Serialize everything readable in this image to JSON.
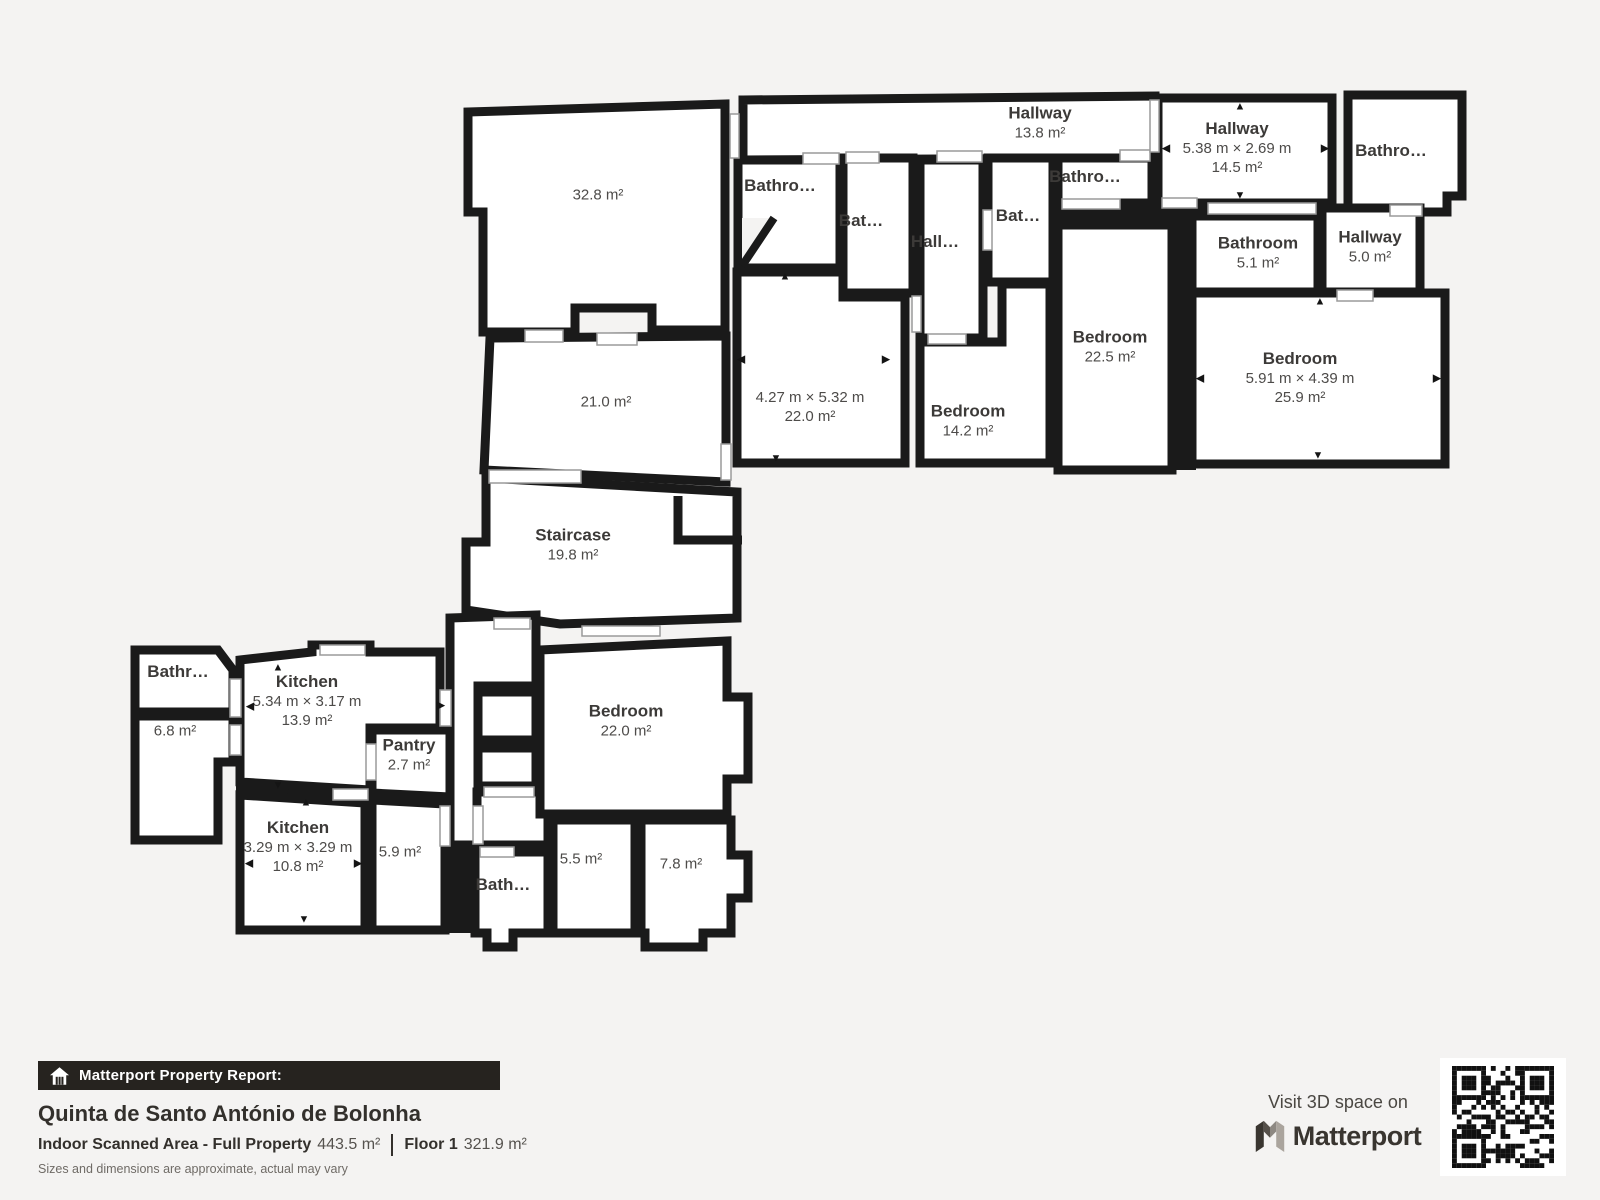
{
  "page": {
    "background": "#f4f3f2",
    "wall_color": "#1a1a1a"
  },
  "plan": {
    "rooms": [
      {
        "area": "32.8 m²",
        "x": 598,
        "y": 195
      },
      {
        "area": "21.0 m²",
        "x": 606,
        "y": 402
      },
      {
        "name": "Staircase",
        "area": "19.8 m²",
        "x": 573,
        "y": 545
      },
      {
        "name": "Hallway",
        "area": "13.8 m²",
        "x": 1040,
        "y": 123
      },
      {
        "name": "Hallway",
        "dims": "5.38 m × 2.69 m",
        "area": "14.5 m²",
        "x": 1237,
        "y": 148
      },
      {
        "name": "Bathro…",
        "x": 1391,
        "y": 151
      },
      {
        "name": "Bathroom",
        "area": "5.1 m²",
        "x": 1258,
        "y": 253
      },
      {
        "name": "Hallway",
        "area": "5.0 m²",
        "x": 1370,
        "y": 247
      },
      {
        "name": "Bathro…",
        "x": 780,
        "y": 186
      },
      {
        "name": "Bat…",
        "x": 861,
        "y": 221
      },
      {
        "name": "Hall…",
        "x": 935,
        "y": 242
      },
      {
        "name": "Bat…",
        "x": 1018,
        "y": 216
      },
      {
        "name": "Bathro…",
        "x": 1085,
        "y": 177
      },
      {
        "name": "Bedroom",
        "area": "22.5 m²",
        "x": 1110,
        "y": 347
      },
      {
        "dims": "4.27 m × 5.32 m",
        "area": "22.0 m²",
        "x": 810,
        "y": 407
      },
      {
        "name": "Bedroom",
        "area": "14.2 m²",
        "x": 968,
        "y": 421
      },
      {
        "name": "Bedroom",
        "dims": "5.91 m × 4.39 m",
        "area": "25.9 m²",
        "x": 1300,
        "y": 378
      },
      {
        "name": "Bathr…",
        "x": 178,
        "y": 672
      },
      {
        "area": "6.8 m²",
        "x": 175,
        "y": 731
      },
      {
        "name": "Kitchen",
        "dims": "5.34 m × 3.17 m",
        "area": "13.9 m²",
        "x": 307,
        "y": 701
      },
      {
        "name": "Pantry",
        "area": "2.7 m²",
        "x": 409,
        "y": 755
      },
      {
        "name": "Kitchen",
        "dims": "3.29 m × 3.29 m",
        "area": "10.8 m²",
        "x": 298,
        "y": 847
      },
      {
        "area": "5.9 m²",
        "x": 400,
        "y": 852
      },
      {
        "name": "Bath…",
        "x": 503,
        "y": 885
      },
      {
        "area": "5.5 m²",
        "x": 581,
        "y": 859
      },
      {
        "area": "7.8 m²",
        "x": 681,
        "y": 864
      },
      {
        "name": "Bedroom",
        "area": "22.0 m²",
        "x": 626,
        "y": 721
      }
    ],
    "dimension_arrows": [
      {
        "dir": "up",
        "x": 785,
        "y": 277
      },
      {
        "dir": "down",
        "x": 776,
        "y": 459
      },
      {
        "dir": "left",
        "x": 741,
        "y": 360
      },
      {
        "dir": "right",
        "x": 886,
        "y": 360
      },
      {
        "dir": "up",
        "x": 1240,
        "y": 107
      },
      {
        "dir": "down",
        "x": 1240,
        "y": 196
      },
      {
        "dir": "left",
        "x": 1166,
        "y": 149
      },
      {
        "dir": "right",
        "x": 1325,
        "y": 149
      },
      {
        "dir": "up",
        "x": 1320,
        "y": 302
      },
      {
        "dir": "down",
        "x": 1318,
        "y": 456
      },
      {
        "dir": "left",
        "x": 1200,
        "y": 379
      },
      {
        "dir": "right",
        "x": 1437,
        "y": 379
      },
      {
        "dir": "up",
        "x": 278,
        "y": 668
      },
      {
        "dir": "down",
        "x": 278,
        "y": 786
      },
      {
        "dir": "left",
        "x": 250,
        "y": 707
      },
      {
        "dir": "right",
        "x": 441,
        "y": 706
      },
      {
        "dir": "up",
        "x": 306,
        "y": 803
      },
      {
        "dir": "down",
        "x": 304,
        "y": 920
      },
      {
        "dir": "left",
        "x": 249,
        "y": 864
      },
      {
        "dir": "right",
        "x": 358,
        "y": 864
      }
    ],
    "arrow_glyphs": {
      "up": "▲",
      "down": "▼",
      "left": "◀",
      "right": "▶"
    }
  },
  "footer": {
    "banner_label": "Matterport Property Report:",
    "title": "Quinta de Santo António de Bolonha",
    "area_label": "Indoor Scanned Area - Full Property",
    "area_value": "443.5 m²",
    "floor_label": "Floor 1",
    "floor_value": "321.9 m²",
    "disclaimer": "Sizes and dimensions are approximate, actual may vary"
  },
  "cta": {
    "visit_label": "Visit 3D space on",
    "brand": "Matterport"
  }
}
